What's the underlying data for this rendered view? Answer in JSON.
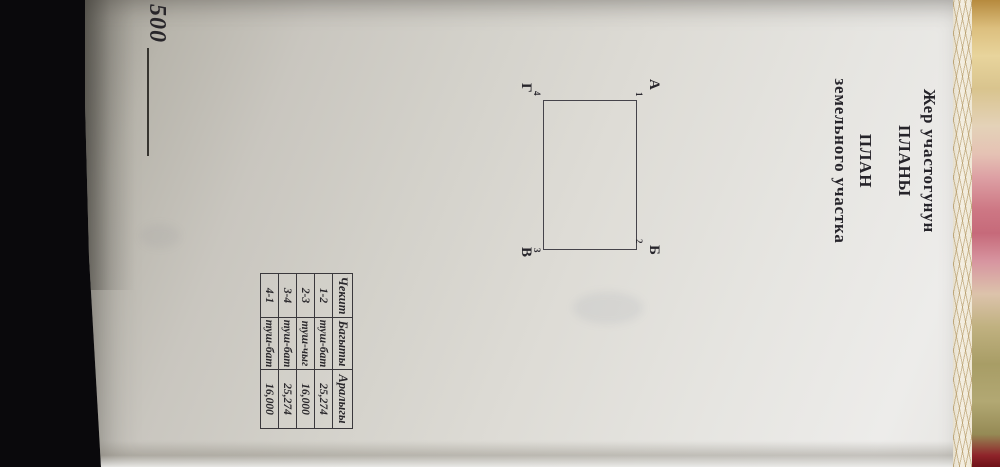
{
  "photo": {
    "scale_label": "500",
    "colors": {
      "background": "#0a090c",
      "paper": "#dddbd5",
      "ink": "#232225",
      "fabric_pink": "#c66a7a",
      "fabric_gold": "#dcbf7e",
      "fabric_olive": "#a89d66"
    }
  },
  "document": {
    "title_lines": [
      "Жер участогунун",
      "ПЛАНЫ",
      "ПЛАН",
      "земельного участка"
    ]
  },
  "plot": {
    "corners": [
      {
        "letter": "А",
        "number": "1"
      },
      {
        "letter": "Б",
        "number": "2"
      },
      {
        "letter": "В",
        "number": "3"
      },
      {
        "letter": "Г",
        "number": "4"
      }
    ]
  },
  "table": {
    "headers": [
      "Чекит",
      "Багыты",
      "Аралыгы"
    ],
    "rows": [
      [
        "1-2",
        "туш-бат",
        "25,274"
      ],
      [
        "2-3",
        "туш-чыг",
        "16,000"
      ],
      [
        "3-4",
        "туш-бат",
        "25,274"
      ],
      [
        "4-1",
        "туш-бат",
        "16,000"
      ]
    ]
  }
}
